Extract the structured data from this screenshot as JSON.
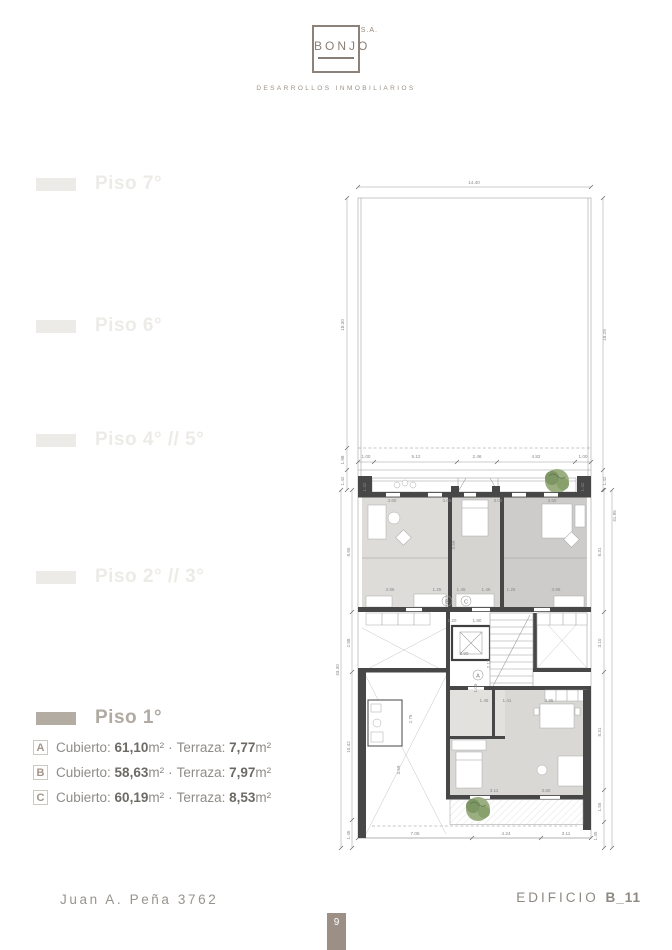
{
  "logo": {
    "name": "BONJO",
    "sa": "S.A.",
    "tagline": "DESARROLLOS INMOBILIARIOS"
  },
  "sidebar": {
    "items": [
      {
        "label": "Piso 7°",
        "active": false
      },
      {
        "label": "Piso 6°",
        "active": false
      },
      {
        "label": "Piso 4° // 5°",
        "active": false
      },
      {
        "label": "Piso 2° // 3°",
        "active": false
      },
      {
        "label": "Piso 1°",
        "active": true
      }
    ]
  },
  "legend": {
    "cubierto_label": "Cubierto:",
    "terraza_label": "Terraza:",
    "m2": "m²",
    "dot": "·",
    "units": [
      {
        "letter": "A",
        "cubierto": "61,10",
        "terraza": "7,77"
      },
      {
        "letter": "B",
        "cubierto": "58,63",
        "terraza": "7,97"
      },
      {
        "letter": "C",
        "cubierto": "60,19",
        "terraza": "8,53"
      }
    ]
  },
  "footer": {
    "address": "Juan A. Peña 3762",
    "building_label": "EDIFICIO",
    "building_code": "B_11",
    "page_number": "9"
  },
  "plan": {
    "unit_labels": {
      "a": "A",
      "b": "B",
      "c": "C"
    },
    "dims": [
      "14.40",
      "18.30",
      "1.98",
      "1.42",
      "43.30",
      "8.65",
      "2.88",
      "10.42",
      "1.45",
      "18.28",
      "1.42",
      "41.95",
      "8.31",
      "3.10",
      "8.31",
      "1.55",
      "1.45",
      "1.00",
      "5.12",
      "2.46",
      "4.82",
      "1.00",
      "1.42",
      "1.42",
      "3.60",
      "3.05",
      "3.05",
      "3.60",
      "3.59",
      "3.85",
      "1.25",
      "1.45",
      "1.45",
      "1.25",
      "3.85",
      "1.20",
      "1.80",
      "2.90",
      "2.12",
      "1.05",
      "1.45",
      "1.41",
      "3.85",
      "2.75",
      "3.59",
      "3.11",
      "3.60",
      "7.05",
      "4.24",
      "3.11"
    ]
  }
}
